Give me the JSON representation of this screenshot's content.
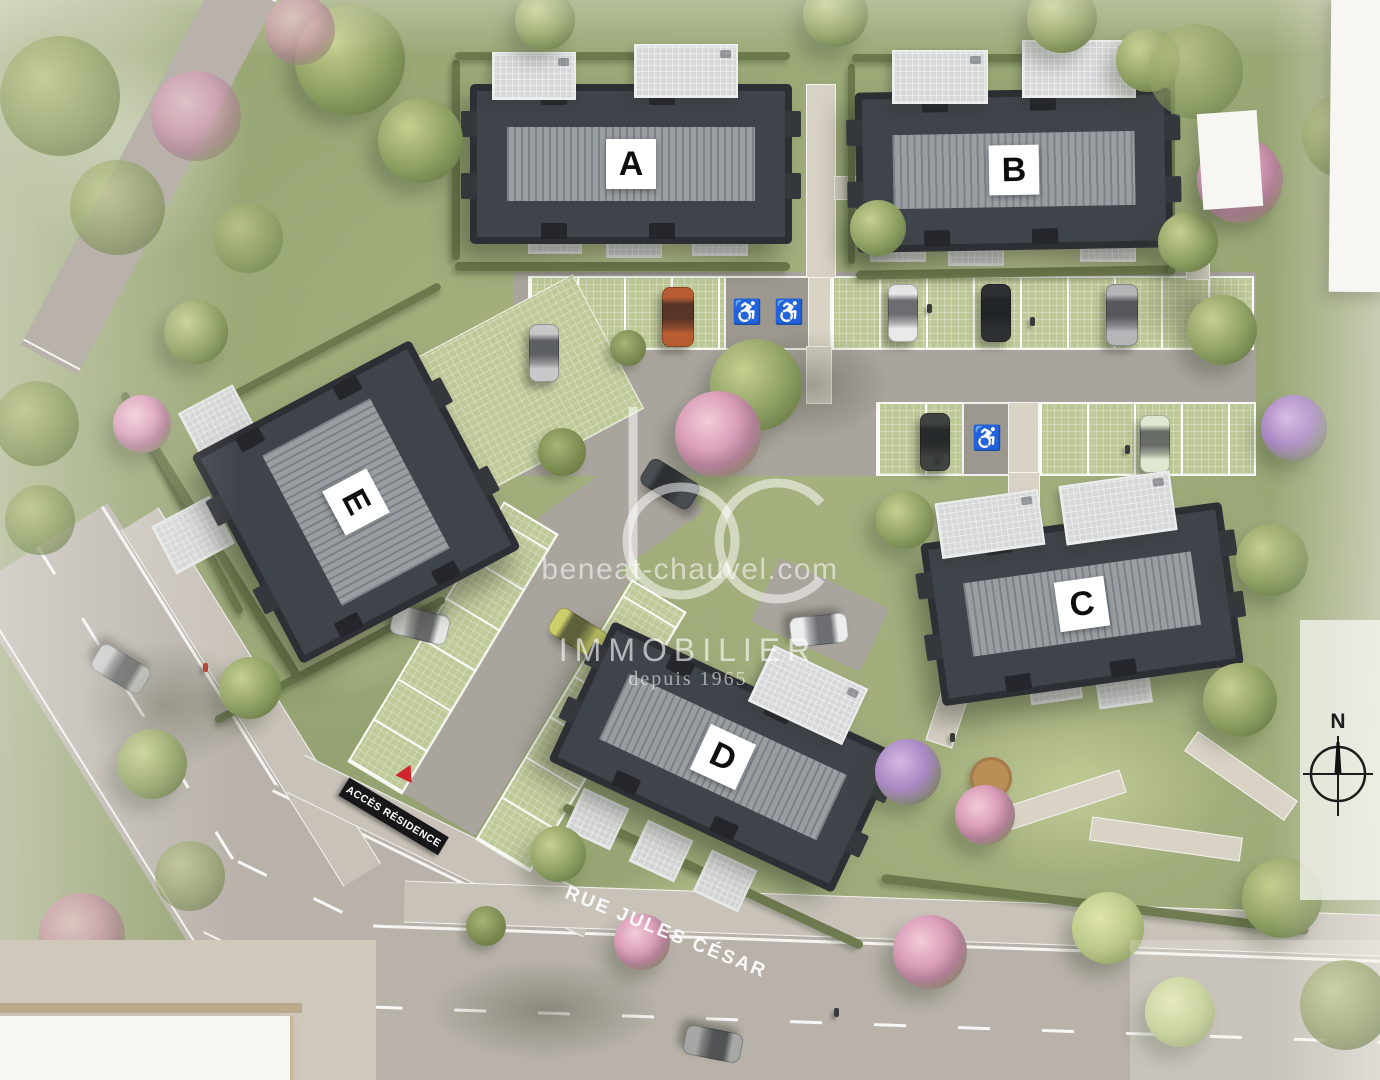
{
  "site": {
    "buildings": [
      {
        "id": "A",
        "label": "A"
      },
      {
        "id": "B",
        "label": "B"
      },
      {
        "id": "C",
        "label": "C"
      },
      {
        "id": "D",
        "label": "D"
      },
      {
        "id": "E",
        "label": "E"
      }
    ],
    "signs": {
      "access_residence": "ACCÈS RÉSIDENCE",
      "street_name": "RUE JULES CÉSAR"
    },
    "compass": {
      "north_label": "N"
    },
    "watermark": {
      "logo": "bc",
      "website": "beneat-chauvel.com",
      "brand": "IMMOBILIER",
      "tagline": "depuis 1965"
    },
    "parking": {
      "handicap_symbol": "♿"
    },
    "colors": {
      "roof_dark": "#3f434a",
      "roof_stripe": "#999ea2",
      "label_bg": "#ffffff",
      "label_text": "#0e0e0e",
      "road": "#b8b2aa",
      "paver_green": "#bec998",
      "grass": "#9aa876",
      "access_sign_bg": "#17171a",
      "access_triangle": "#d0252c",
      "street_text": "#ffffff",
      "watermark": "#ffffff"
    }
  }
}
